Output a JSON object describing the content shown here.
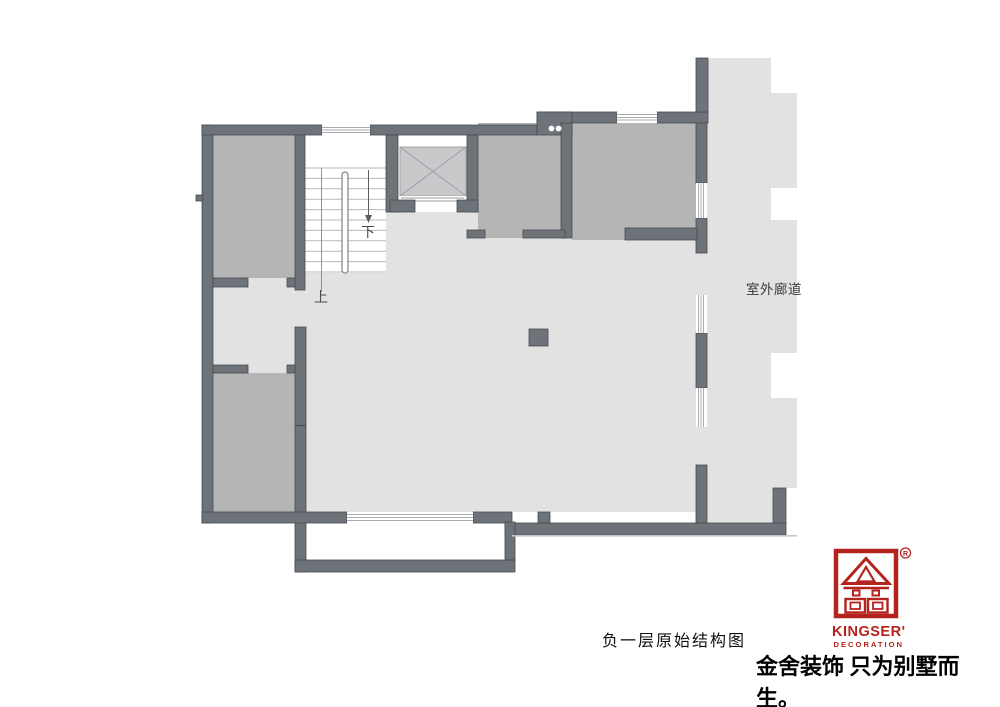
{
  "title": "负一层原始结构图",
  "plan": {
    "labels": {
      "corridor": "室外廊道",
      "stair_up": "上",
      "stair_down": "下"
    },
    "colors": {
      "wall": "#6d7378",
      "wall_border": "#464c52",
      "room_fill": "#b5b5b6",
      "hall_fill": "#e2e2e3",
      "elevator_fill": "#c9c9cb"
    }
  },
  "branding": {
    "logo_name": "KINGSER'",
    "logo_subtitle": "DECORATION",
    "registered": "R",
    "slogan": "金舍装饰 只为别墅而生。",
    "brand_red": "#b5231e"
  }
}
